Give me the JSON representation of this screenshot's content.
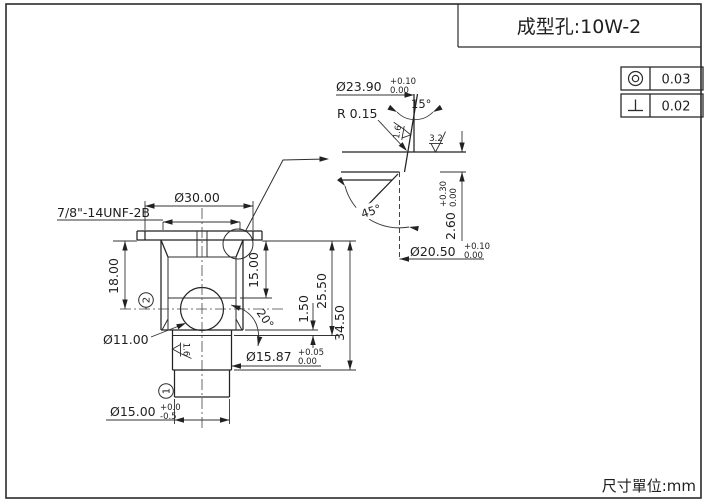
{
  "sheet": {
    "title": "成型孔:10W-2",
    "units_label": "尺寸單位:mm"
  },
  "gdt_frames": [
    {
      "symbol": "concentricity",
      "value": "0.03"
    },
    {
      "symbol": "perpendicularity",
      "value": "0.02"
    }
  ],
  "main_view": {
    "thread_callout": "7/8\"-14UNF-2B",
    "dia_top": "Ø30.00",
    "depth_left": "18.00",
    "depth_right": "15.00",
    "land_height": "1.50",
    "depth_seat": "25.50",
    "depth_total": "34.50",
    "seat_angle": "20°",
    "ball_dia": "Ø11.00",
    "roughness_bore": "1.6",
    "stem_dia": {
      "nominal": "Ø15.87",
      "tol_up": "+0.05",
      "tol_dn": "0.00"
    },
    "tip_dia": {
      "nominal": "Ø15.00",
      "tol_up": "+0.0",
      "tol_dn": "-0.5"
    },
    "datum_upper": "2",
    "datum_lower": "1"
  },
  "detail_view": {
    "bore_dia": {
      "nominal": "Ø23.90",
      "tol_up": "+0.10",
      "tol_dn": "0.00"
    },
    "taper_angle": "15°",
    "corner_radius": "R 0.15",
    "roughness_taper": "1.6",
    "roughness_face": "3.2",
    "chamfer_angle": "45°",
    "counterbore_depth": {
      "nominal": "2.60",
      "tol_up": "+0.30",
      "tol_dn": "0.00"
    },
    "seat_dia": {
      "nominal": "Ø20.50",
      "tol_up": "+0.10",
      "tol_dn": "0.00"
    }
  }
}
